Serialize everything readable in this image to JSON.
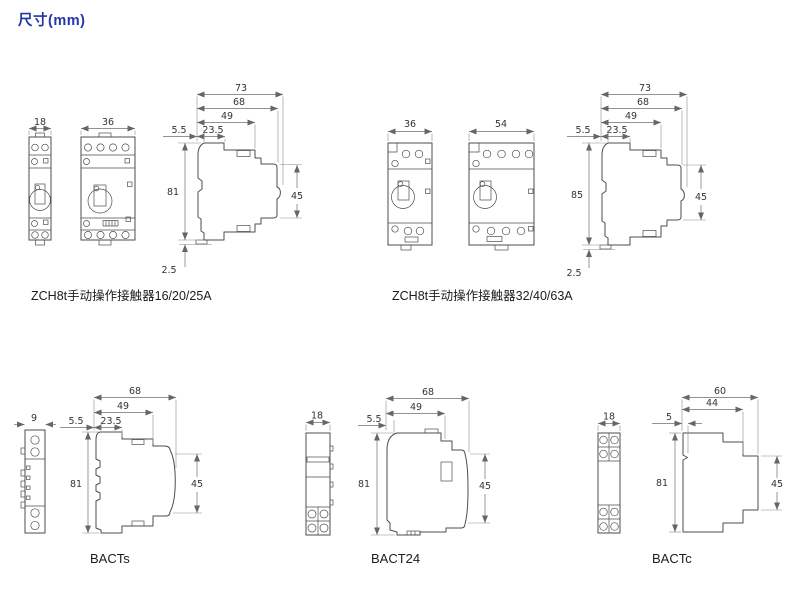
{
  "page": {
    "title": "尺寸(mm)"
  },
  "colors": {
    "title": "#2236a8",
    "line": "#4d4d4d"
  },
  "groups": {
    "zch8t_small": {
      "caption": "ZCH8t手动操作接触器16/20/25A",
      "front1_width": "18",
      "front2_width": "36",
      "dims": {
        "total_depth": "73",
        "d68": "68",
        "d49": "49",
        "d23_5": "23.5",
        "d5_5": "5.5",
        "height": "81",
        "d45": "45",
        "bottom": "2.5"
      }
    },
    "zch8t_large": {
      "caption": "ZCH8t手动操作接触器32/40/63A",
      "front1_width": "36",
      "front2_width": "54",
      "dims": {
        "total_depth": "73",
        "d68": "68",
        "d49": "49",
        "d23_5": "23.5",
        "d5_5": "5.5",
        "height": "85",
        "d45": "45",
        "bottom": "2.5"
      }
    },
    "bacts": {
      "caption": "BACTs",
      "front_width": "9",
      "dims": {
        "d68": "68",
        "d49": "49",
        "d23_5": "23.5",
        "d5_5": "5.5",
        "height": "81",
        "d45": "45"
      }
    },
    "bact24": {
      "caption": "BACT24",
      "front_width": "18",
      "dims": {
        "d68": "68",
        "d49": "49",
        "d5_5": "5.5",
        "height": "81",
        "d45": "45"
      }
    },
    "bactc": {
      "caption": "BACTc",
      "front_width": "18",
      "dims": {
        "d60": "60",
        "d44": "44",
        "d5": "5",
        "height": "81",
        "d45": "45"
      }
    }
  }
}
